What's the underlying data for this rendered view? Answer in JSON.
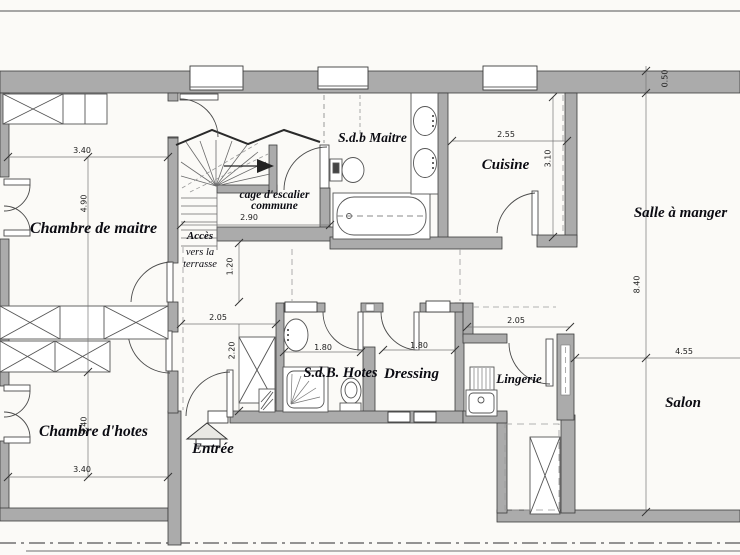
{
  "labels": {
    "chambre_de_maitre": "Chambre de maitre",
    "sdb_maitre": "S.d.b Maitre",
    "cage_escalier_line1": "cage d'escalier",
    "cage_escalier_line2": "commune",
    "acces_line1": "Accès",
    "acces_line2": "vers la",
    "acces_line3": "terrasse",
    "cuisine": "Cuisine",
    "salle_a_manger": "Salle à manger",
    "chambre_hotes": "Chambre d'hotes",
    "entree": "Entrée",
    "sdb_hotes": "S.d.B. Hotes",
    "dressing": "Dressing",
    "lingerie": "Lingerie",
    "salon": "Salon"
  },
  "dimensions": {
    "master_width": "3.40",
    "master_depth": "4.90",
    "stair_width": "2.90",
    "cuisine_width": "2.55",
    "cuisine_depth": "3.10",
    "wall_thickness": "0.50",
    "dining_depth": "8.40",
    "salon_width": "4.55",
    "hall_width": "1.20",
    "hall_length": "2.05",
    "hall_height": "2.20",
    "sdb_hotes_width": "1.80",
    "dressing_width": "1.80",
    "lingerie_width": "2.05",
    "guest_depth": "3.40",
    "guest_width": "3.40"
  },
  "colors": {
    "wall_fill": "#ababab",
    "wall_edge": "#3c3c3c",
    "line": "#555555",
    "paper": "#fbfaf7"
  }
}
